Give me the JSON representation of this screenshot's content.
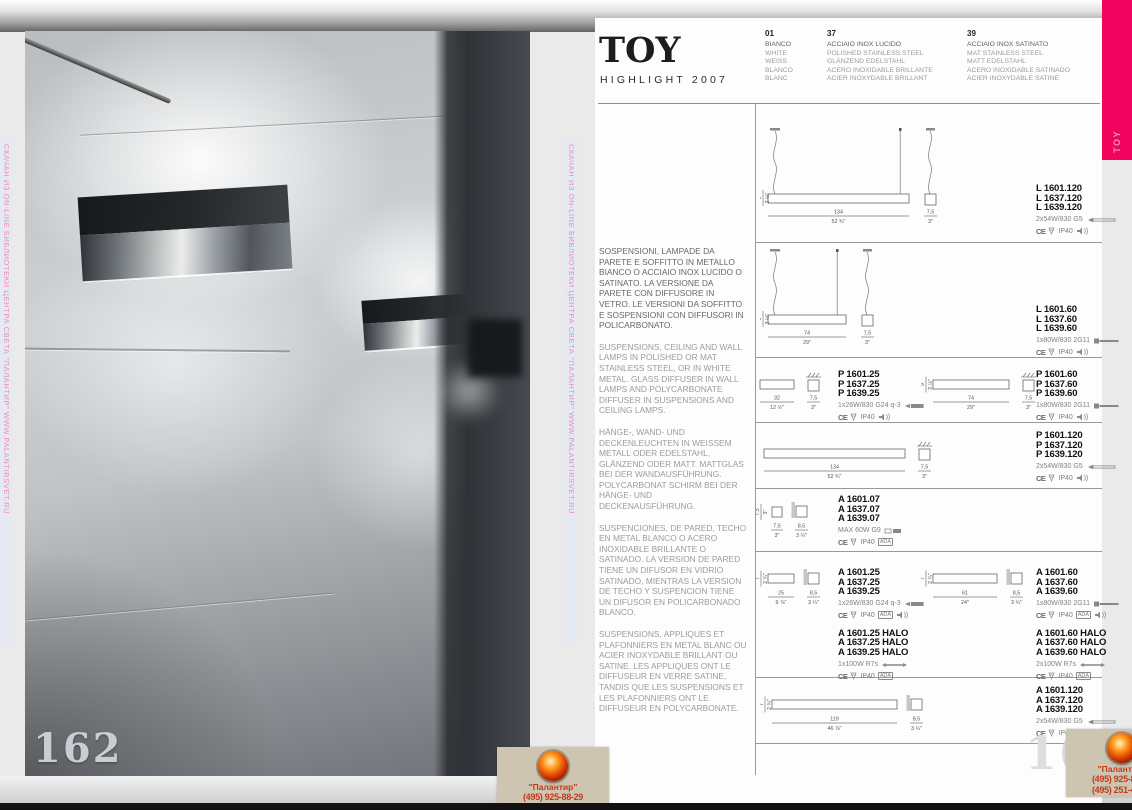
{
  "colors": {
    "accent_pink": "#f0045e",
    "stamp_red": "#c43a18",
    "watermark_pink": "#ec8faa"
  },
  "left_page": {
    "page_number": "162"
  },
  "right_page": {
    "page_number": "163"
  },
  "tab": {
    "label": "TOY"
  },
  "header": {
    "title": "TOY",
    "subtitle": "HIGHLIGHT 2007",
    "finishes": [
      {
        "code": "01",
        "names": [
          "BIANCO",
          "WHITE",
          "WEISS",
          "BLANCO",
          "BLANC"
        ]
      },
      {
        "code": "37",
        "names": [
          "ACCIAIO INOX LUCIDO",
          "POLISHED STAINLESS STEEL",
          "GLÄNZEND EDELSTAHL",
          "ACERO INOXIDABLE BRILLANTE",
          "ACIER INOXYDABLE BRILLANT"
        ]
      },
      {
        "code": "39",
        "names": [
          "ACCIAIO INOX SATINATO",
          "MAT STAINLESS STEEL",
          "MATT EDELSTAHL",
          "ACERO INOXIDABLE SATINADO",
          "ACIER INOXYDABLE SATINE"
        ]
      }
    ]
  },
  "descriptions": {
    "it": "SOSPENSIONI, LAMPADE DA PARETE E SOFFITTO IN METALLO  BIANCO O ACCIAIO INOX LUCIDO O SATINATO. LA VERSIONE DA PARETE CON DIFFUSORE IN VETRO. LE VERSIONI DA SOFFITTO E SOSPENSIONI CON DIFFUSORI IN POLICARBONATO.",
    "en": "SUSPENSIONS, CEILING AND WALL LAMPS IN POLISHED OR MAT STAINLESS STEEL, OR IN WHITE METAL. GLASS DIFFUSER IN WALL LAMPS AND POLYCARBONATE DIFFUSER IN SUSPENSIONS AND CEILING LAMPS.",
    "de": "HÄNGE-, WAND- UND DECKENLEUCHTEN IN WEISSEM METALL  ODER EDELSTAHL, GLÄNZEND ODER MATT. MATTGLAS BEI DER WANDAUSFÜHRUNG. POLYCARBONAT SCHIRM BEI DER HÄNGE- UND DECKENAUSFÜHRUNG.",
    "es": "SUSPENCIONES, DE PARED, TECHO EN METAL BLANCO O ACERO INOXIDABLE BRILLANTE O SATINADO. LA VERSION DE PARED TIENE UN DIFUSOR EN VIDRIO SATINADO, MIENTRAS LA VERSION DE TECHO Y SUSPENCION TIENE UN DIFUSOR EN POLICARBONADO BLANCO.",
    "fr": "SUSPENSIONS, APPLIQUES ET PLAFONNIERS EN METAL BLANC OU ACIER INOXYDABLE BRILLANT OU SATINE. LES APPLIQUES ONT LE DIFFUSEUR EN VERRE SATINE, TANDIS QUE LES SUSPENSIONS ET LES PLAFONNIERS ONT LE DIFFUSEUR EN POLYCARBONATE."
  },
  "labels": {
    "ce": "CE",
    "ip": "IP40",
    "ada": "ADA"
  },
  "products": [
    {
      "blocks": [
        {
          "pos": "wide",
          "diagram": {
            "style": "suspension",
            "w": "134",
            "wi": "52 ¾\"",
            "d": "7,5",
            "di": "3\"",
            "h": "9",
            "hi": "3 ½\""
          },
          "codes": [
            "L 1601.120",
            "L 1637.120",
            "L 1639.120"
          ],
          "lamp": "2x54W/830 G5",
          "lamp_icon": "fluorescent-tube-icon",
          "ada": false,
          "speaker": true
        }
      ]
    },
    {
      "blocks": [
        {
          "pos": "wide",
          "diagram": {
            "style": "suspension",
            "w": "74",
            "wi": "29\"",
            "d": "7,5",
            "di": "3\"",
            "h": "9",
            "hi": "3 ½\""
          },
          "codes": [
            "L 1601.60",
            "L 1637.60",
            "L 1639.60"
          ],
          "lamp": "1x80W/830 2G11",
          "lamp_icon": "compact-tube-icon",
          "ada": false,
          "speaker": true
        }
      ]
    },
    {
      "blocks": [
        {
          "pos": "left",
          "diagram": {
            "style": "ceiling",
            "w": "32",
            "wi": "12 ½\"",
            "d": "7,5",
            "di": "3\""
          },
          "codes": [
            "P 1601.25",
            "P 1637.25",
            "P 1639.25"
          ],
          "lamp": "1x26W/830 G24 q-3",
          "lamp_icon": "compact-fluorescent-icon",
          "ada": false,
          "speaker": true
        },
        {
          "pos": "right",
          "diagram": {
            "style": "ceiling",
            "w": "74",
            "wi": "29\"",
            "d": "7,5",
            "di": "3\"",
            "h": "9",
            "hi": "3 ½\""
          },
          "codes": [
            "P 1601.60",
            "P 1637.60",
            "P 1639.60"
          ],
          "lamp": "1x80W/830 2G11",
          "lamp_icon": "compact-tube-icon",
          "ada": false,
          "speaker": true
        }
      ]
    },
    {
      "blocks": [
        {
          "pos": "wide",
          "diagram": {
            "style": "ceiling",
            "w": "134",
            "wi": "52 ¾\"",
            "d": "7,5",
            "di": "3\""
          },
          "codes": [
            "P 1601.120",
            "P 1637.120",
            "P 1639.120"
          ],
          "lamp": "2x54W/830 G5",
          "lamp_icon": "fluorescent-tube-icon",
          "ada": false,
          "speaker": true
        }
      ]
    },
    {
      "blocks": [
        {
          "pos": "left",
          "diagram": {
            "style": "wall-small",
            "w": "7,5",
            "wi": "3\"",
            "d": "8,5",
            "di": "3 ¼\"",
            "h": "7,5",
            "hi": "3\""
          },
          "codes": [
            "A 1601.07",
            "A 1637.07",
            "A 1639.07"
          ],
          "lamp": "MAX 60W G9",
          "lamp_icon": "halogen-capsule-icon",
          "ada": true,
          "speaker": false
        }
      ]
    },
    {
      "blocks": [
        {
          "pos": "left",
          "diagram": {
            "style": "wall",
            "w": "25",
            "wi": "9 ⅞\"",
            "d": "8,5",
            "di": "3 ¼\"",
            "h": "7",
            "hi": "2 ¾\""
          },
          "codes": [
            "A 1601.25",
            "A 1637.25",
            "A 1639.25"
          ],
          "lamp": "1x26W/830 G24 q-3",
          "lamp_icon": "compact-fluorescent-icon",
          "ada": true,
          "speaker": true,
          "halo": {
            "codes": [
              "A 1601.25 HALO",
              "A 1637.25 HALO",
              "A 1639.25 HALO"
            ],
            "lamp": "1x100W R7s",
            "lamp_icon": "linear-halogen-icon",
            "ada": true,
            "speaker": false
          }
        },
        {
          "pos": "right",
          "diagram": {
            "style": "wall",
            "w": "61",
            "wi": "24\"",
            "d": "8,5",
            "di": "3 ¼\"",
            "h": "7",
            "hi": "2 ¾\""
          },
          "codes": [
            "A 1601.60",
            "A 1637.60",
            "A 1639.60"
          ],
          "lamp": "1x80W/830 2G11",
          "lamp_icon": "compact-tube-icon",
          "ada": true,
          "speaker": true,
          "halo": {
            "codes": [
              "A 1601.60 HALO",
              "A 1637.60 HALO",
              "A 1639.60 HALO"
            ],
            "lamp": "2x100W R7s",
            "lamp_icon": "linear-halogen-icon",
            "ada": true,
            "speaker": false
          }
        }
      ]
    },
    {
      "blocks": [
        {
          "pos": "wide",
          "diagram": {
            "style": "wall",
            "w": "119",
            "wi": "46 ⅞\"",
            "d": "8,5",
            "di": "3 ¼\"",
            "h": "7",
            "hi": "2 ¾\""
          },
          "codes": [
            "A 1601.120",
            "A 1637.120",
            "A 1639.120"
          ],
          "lamp": "2x54W/830 G5",
          "lamp_icon": "fluorescent-tube-icon",
          "ada": true,
          "speaker": true
        }
      ]
    }
  ],
  "watermark": {
    "strip_text": "СКАЧАН ИЗ ON-LINE БИБЛИОТЕКИ ЦЕНТРА СВЕТА \"ПАЛАНТИР\"   WWW.PALANTIRSVET.RU",
    "stamp": {
      "name": "\"Палантир\"",
      "phones": [
        "(495) 925-88-29",
        "(495) 251-47-42"
      ]
    }
  }
}
